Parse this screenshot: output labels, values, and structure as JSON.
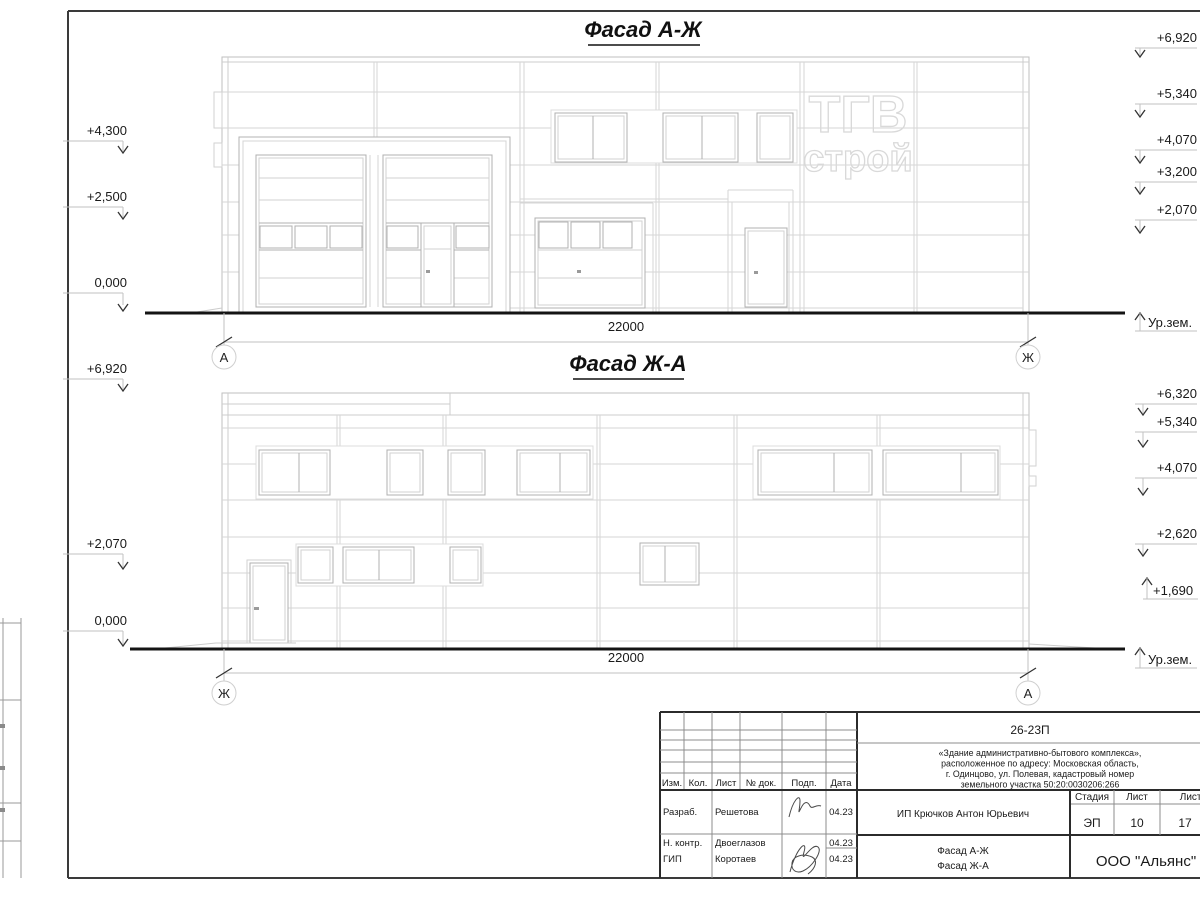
{
  "drawing": {
    "facade_top": {
      "title": "Фасад А-Ж",
      "dimension": "22000",
      "axis_left": "А",
      "axis_right": "Ж",
      "elevations_left": [
        "+4,300",
        "+2,500",
        "0,000"
      ],
      "elevations_right": [
        "+6,920",
        "+5,340",
        "+4,070",
        "+3,200",
        "+2,070"
      ],
      "ground_label": "Ур.зем."
    },
    "facade_bottom": {
      "title": "Фасад Ж-А",
      "dimension": "22000",
      "axis_left": "Ж",
      "axis_right": "А",
      "elevations_left": [
        "+6,920",
        "+2,070",
        "0,000"
      ],
      "elevations_right": [
        "+6,320",
        "+5,340",
        "+4,070",
        "+2,620",
        "+1,690"
      ],
      "ground_label": "Ур.зем."
    },
    "watermark": {
      "line1": "ТГВ",
      "line2": "строй"
    }
  },
  "title_block": {
    "doc_number": "26-23П",
    "project_description_lines": [
      "«Здание административно-бытового комплекса»,",
      "расположенное по адресу: Московская область,",
      "г. Одинцово, ул. Полевая, кадастровый номер",
      "земельного участка 50:20:0030206:266"
    ],
    "header_cols": [
      "Изм.",
      "Кол.",
      "Лист",
      "№ док.",
      "Подп.",
      "Дата"
    ],
    "rows": [
      {
        "role": "Разраб.",
        "name": "Решетова",
        "date": "04.23"
      },
      {
        "role": "Н. контр.",
        "name": "Двоеглазов",
        "date": "04.23"
      },
      {
        "role": "ГИП",
        "name": "Коротаев",
        "date": "04.23"
      }
    ],
    "client": "ИП Крючков Антон Юрьевич",
    "stage_label": "Стадия",
    "stage_value": "ЭП",
    "sheet_label": "Лист",
    "sheet_value": "10",
    "sheets_label": "Листов",
    "sheets_value": "17",
    "sheet_title_line1": "Фасад А-Ж",
    "sheet_title_line2": "Фасад Ж-А",
    "organization": "ООО \"Альянс\""
  }
}
